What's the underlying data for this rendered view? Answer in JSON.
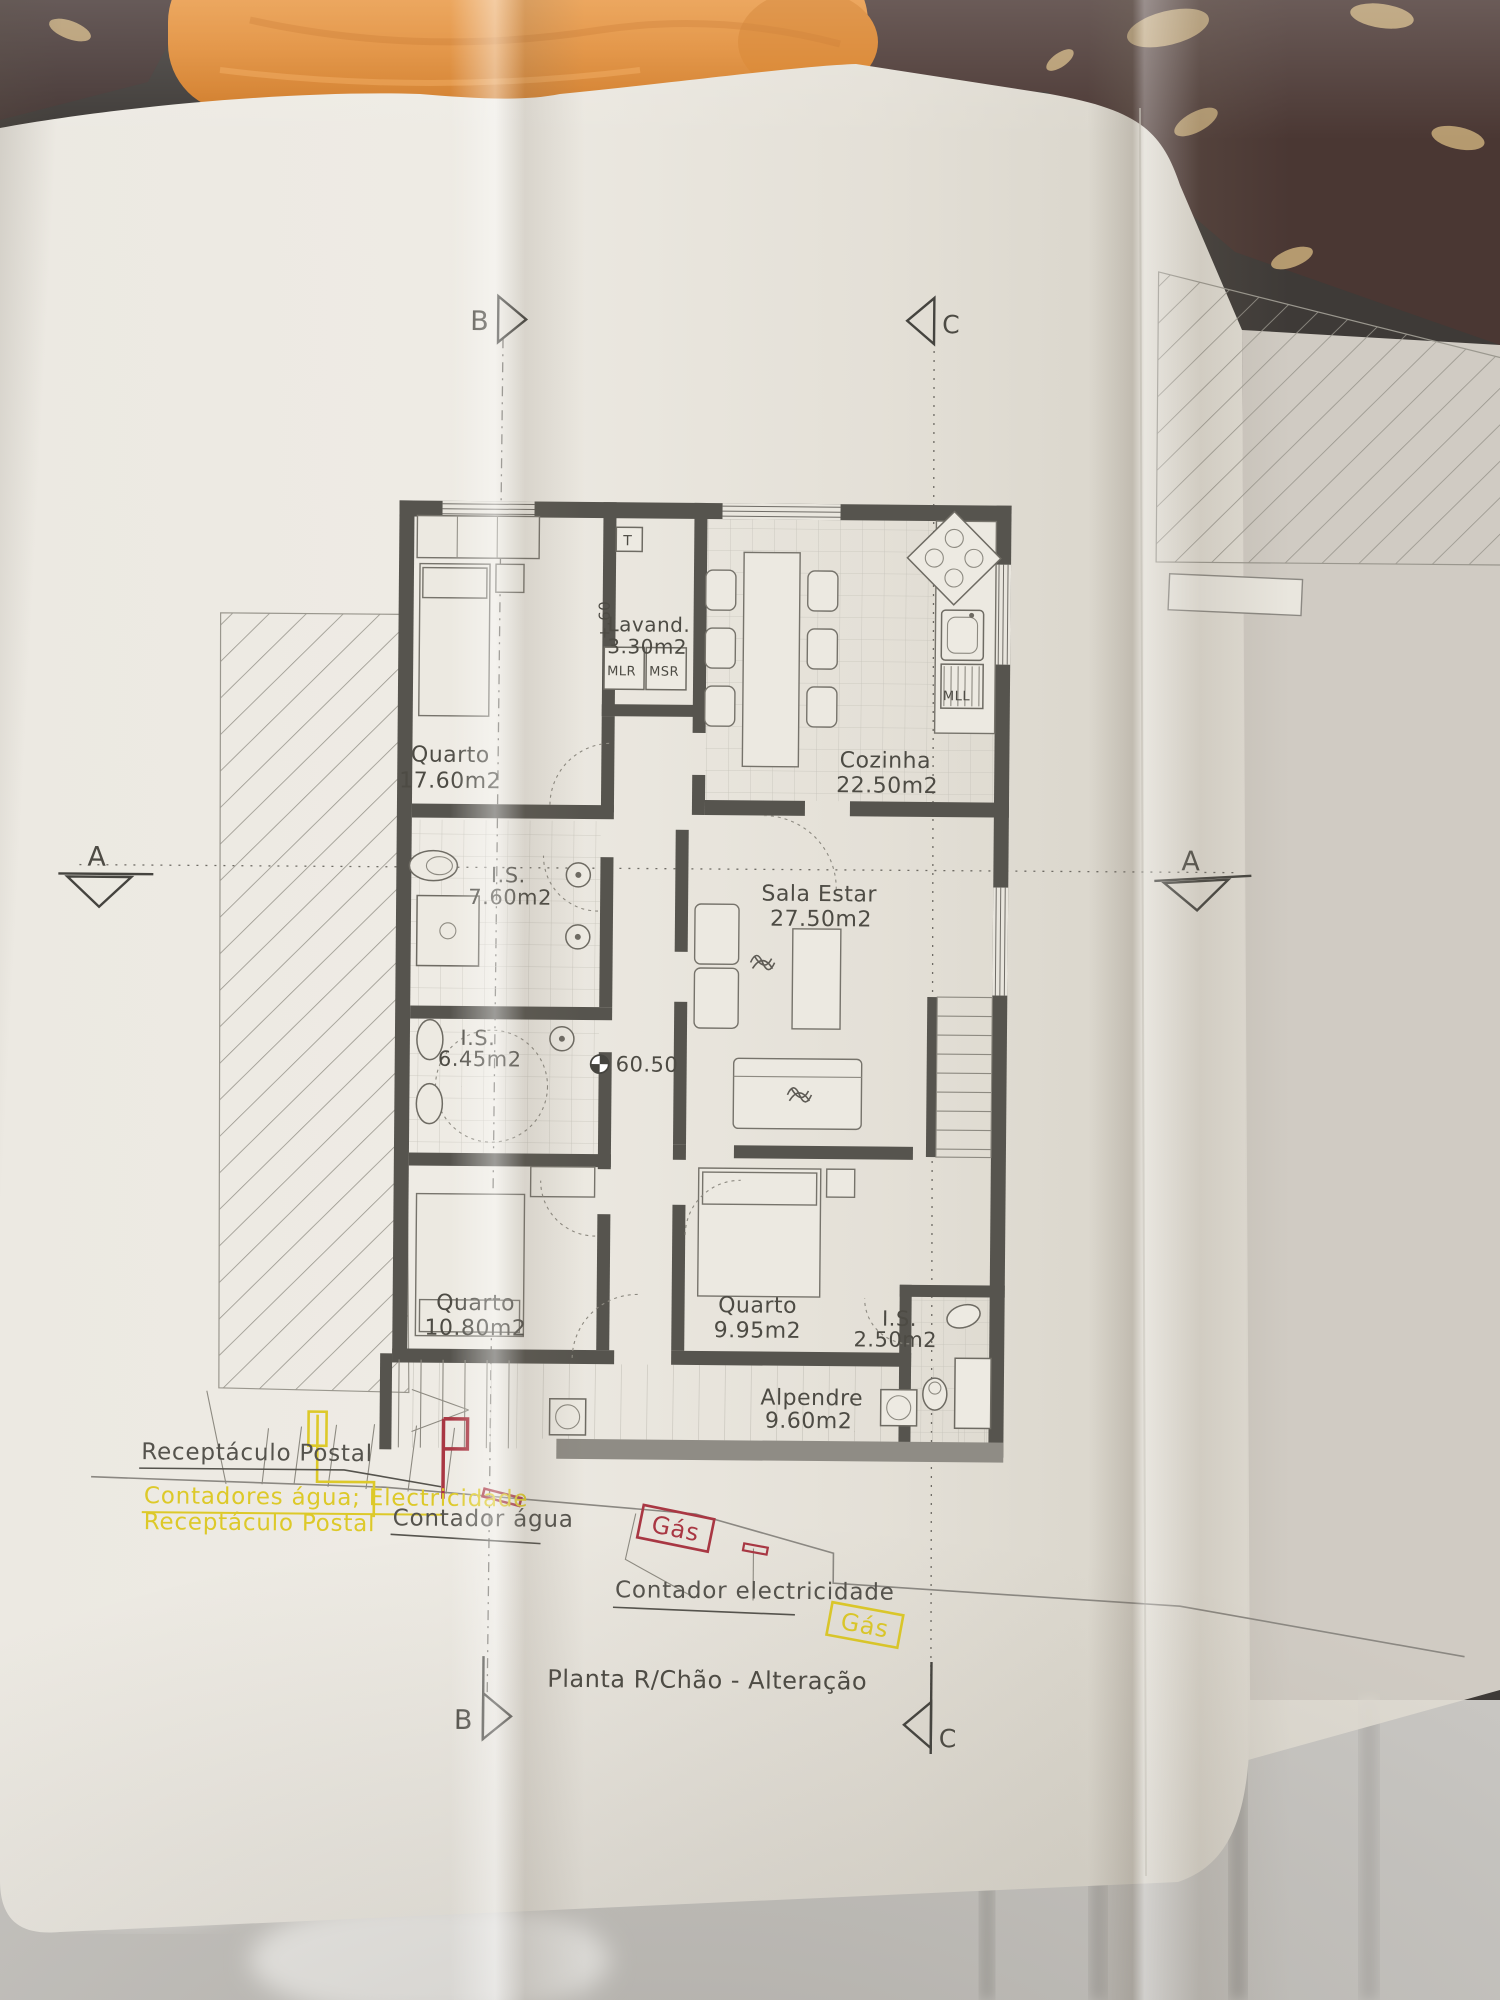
{
  "title": {
    "drawing": "Planta R/Chão - Alteração"
  },
  "markers": {
    "a": "A",
    "b": "B",
    "c": "C"
  },
  "levels": {
    "ground": "60.50",
    "step": "+.60"
  },
  "rooms": [
    {
      "name": "Quarto",
      "area": "17.60m2"
    },
    {
      "name": "Lavand.",
      "area": "3.30m2"
    },
    {
      "name": "Cozinha",
      "area": "22.50m2"
    },
    {
      "name": "I.S.",
      "area": "7.60m2"
    },
    {
      "name": "Sala Estar",
      "area": "27.50m2"
    },
    {
      "name": "I.S.",
      "area": "6.45m2"
    },
    {
      "name": "Quarto",
      "area": "10.80m2"
    },
    {
      "name": "Quarto",
      "area": "9.95m2"
    },
    {
      "name": "I.S.",
      "area": "2.50m2"
    },
    {
      "name": "Alpendre",
      "area": "9.60m2"
    }
  ],
  "equipment": {
    "t": "T",
    "mlr": "MLR",
    "msr": "MSR",
    "mll": "MLL"
  },
  "site": {
    "receptaculo_postal": "Receptáculo Postal",
    "contadores_line1": "Contadores água; Electricidade",
    "contadores_line2": "Receptáculo Postal",
    "contador_agua": "Contador água",
    "contador_electricidade": "Contador electricidade",
    "gas_main": "Gás",
    "gas_secondary": "Gás"
  },
  "colors": {
    "ink": "#4d4b44",
    "wall": "#56544e",
    "annotation_yellow": "#ddc929",
    "annotation_red": "#a93743",
    "paper": "#e9e6de",
    "towel_orange": "#e08a33",
    "table_brown": "#4a3733"
  }
}
